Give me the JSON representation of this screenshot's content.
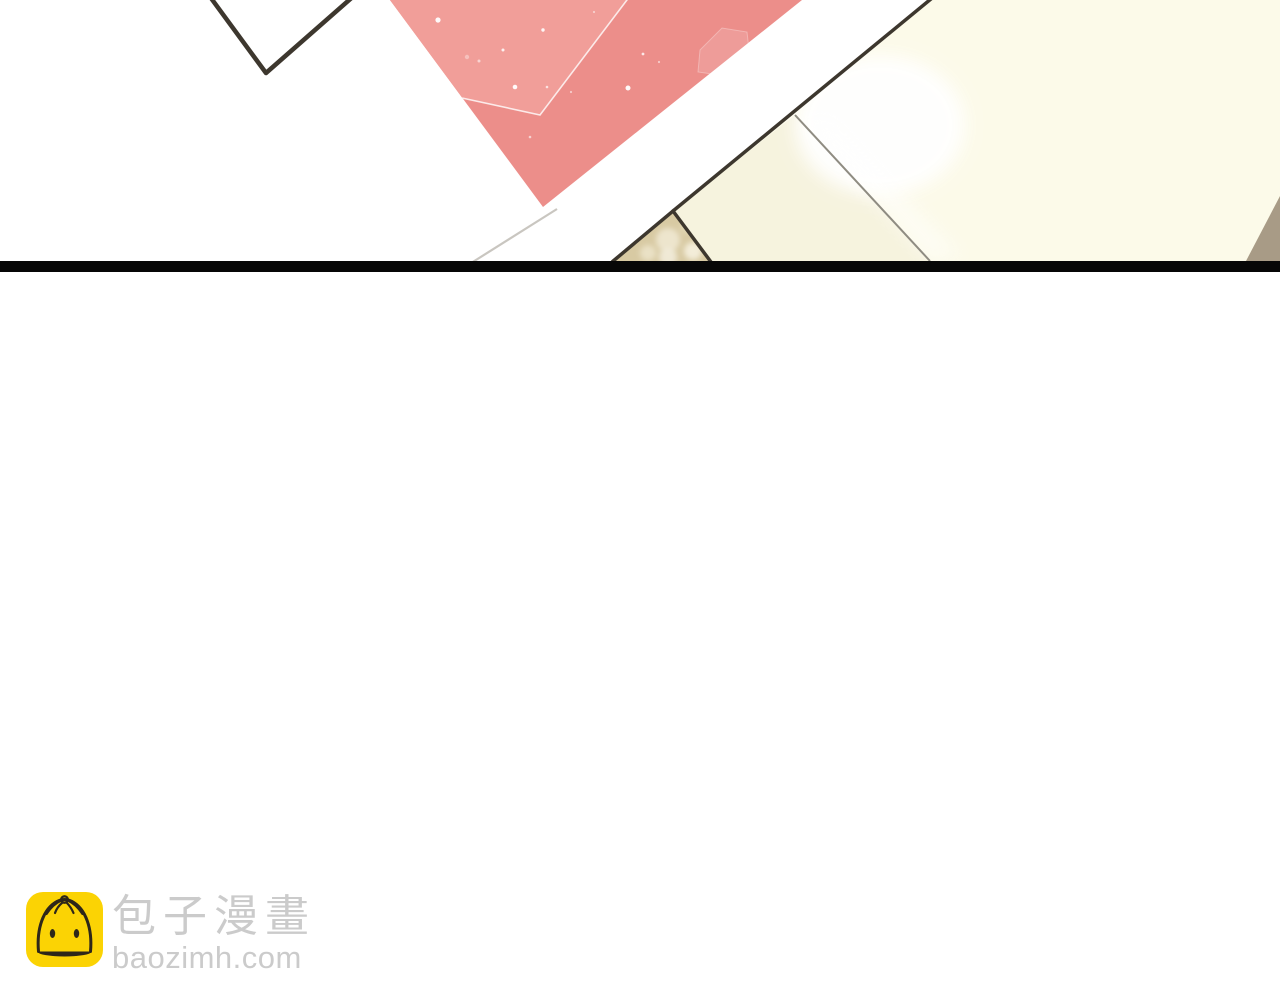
{
  "watermark": {
    "site_name": "包子漫畫",
    "site_url": "baozimh.com"
  },
  "colors": {
    "page_bg": "#ffffff",
    "pink_paper": "#ec8e8a",
    "pink_panel": "#f19e99",
    "cream_paper": "#fcfae9",
    "cream_shade": "#f6f3de",
    "pearl": "#d8caa3",
    "taupe": "#a89b86",
    "outline_dark": "#3d372e",
    "outline_soft": "#8f8c82",
    "faint_line": "#c9c6c0",
    "panel_bar": "#070707",
    "logo_yellow": "#fbd304",
    "logo_ink": "#2e2719",
    "watermark_text": "#cbcbcb"
  }
}
